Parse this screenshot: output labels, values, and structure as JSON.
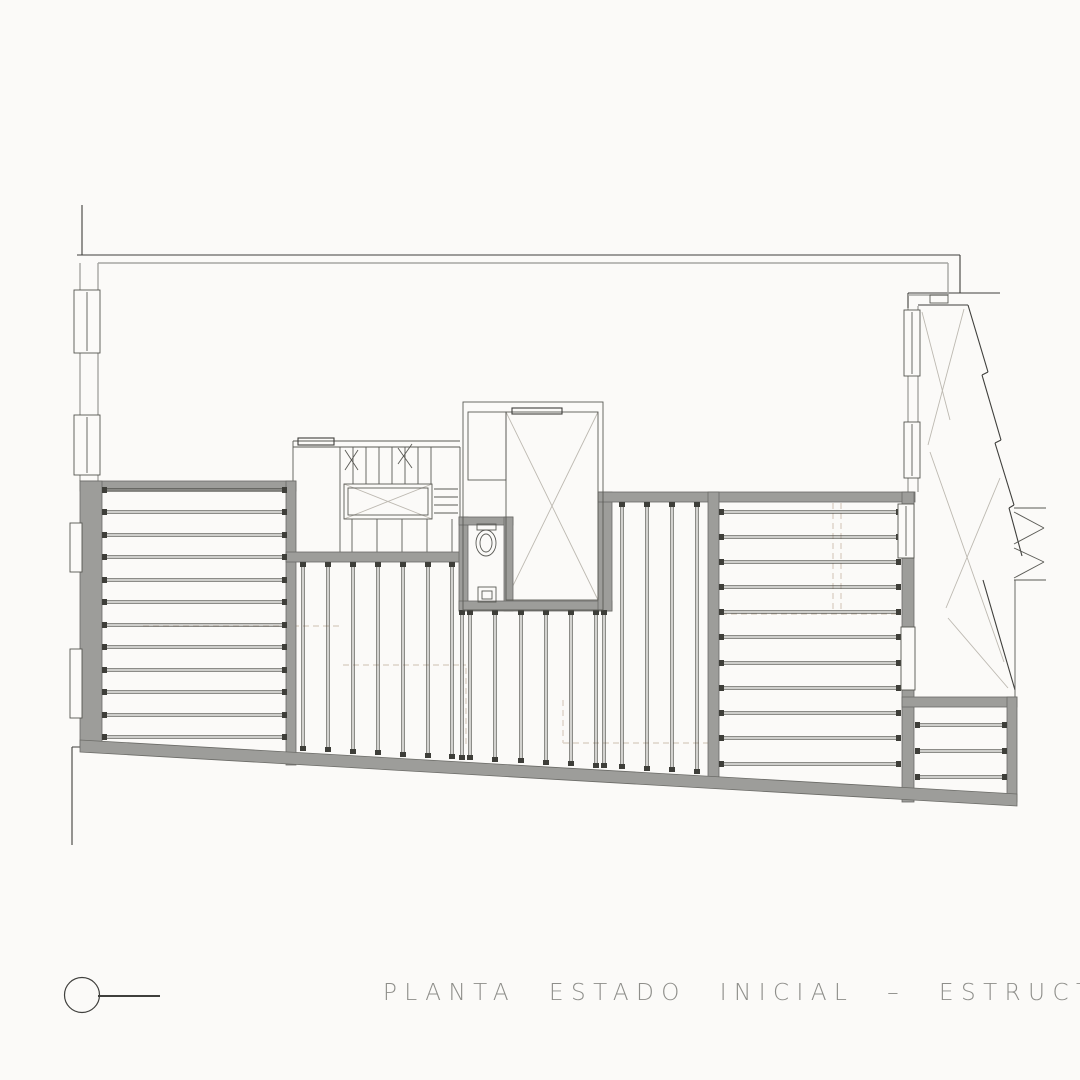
{
  "title": {
    "text": "PLANTA ESTADO INICIAL – ESTRUCTURA",
    "color": "#8e8e8a"
  },
  "marker": {
    "icon": "circle-dash-orientation-icon"
  },
  "colors": {
    "background": "#fbfaf8",
    "wall_fill": "#9d9d9a",
    "wall_edge": "#6b6b67",
    "dark_line": "#3f3f3c",
    "medium_line": "#a6a6a2",
    "thin_line": "#5a5a55",
    "light_diagonal": "#bdb9b1",
    "dashed_hidden": "#ddd3c8",
    "joist": "#4a4a44",
    "title_text": "#8e8e8a"
  },
  "plan": {
    "viewbox": "0 0 1080 1080",
    "base_lines": [
      [
        82,
        205,
        82,
        255,
        "ld"
      ],
      [
        77,
        255,
        960,
        255,
        "ld"
      ],
      [
        960,
        255,
        960,
        293,
        "ld"
      ],
      [
        908,
        293,
        1000,
        293,
        "ld"
      ],
      [
        908,
        293,
        908,
        308,
        "ld"
      ],
      [
        72,
        747,
        92,
        747,
        "ld"
      ],
      [
        72,
        747,
        72,
        845,
        "ld"
      ],
      [
        98,
        263,
        948,
        263,
        "lm"
      ],
      [
        948,
        263,
        948,
        295,
        "lm"
      ],
      [
        908,
        295,
        948,
        295,
        "lm"
      ],
      [
        80,
        263,
        80,
        481,
        "lm"
      ],
      [
        98,
        263,
        98,
        481,
        "lm"
      ],
      [
        908,
        308,
        908,
        492,
        "lm"
      ],
      [
        918,
        306,
        918,
        492,
        "lm"
      ],
      [
        293,
        441,
        460,
        441,
        "lt"
      ],
      [
        293,
        447,
        460,
        447,
        "lt"
      ],
      [
        293,
        441,
        293,
        483,
        "lt"
      ],
      [
        340,
        447,
        340,
        552,
        "lt"
      ],
      [
        460,
        447,
        460,
        552,
        "lt"
      ],
      [
        353,
        447,
        353,
        484,
        "lt"
      ],
      [
        366,
        447,
        366,
        484,
        "lt"
      ],
      [
        379,
        447,
        379,
        484,
        "lt"
      ],
      [
        392,
        447,
        392,
        484,
        "lt"
      ],
      [
        405,
        447,
        405,
        484,
        "lt"
      ],
      [
        418,
        447,
        418,
        484,
        "lt"
      ],
      [
        431,
        447,
        431,
        484,
        "lt"
      ],
      [
        434,
        489,
        458,
        489,
        "lt"
      ],
      [
        434,
        497,
        458,
        497,
        "lt"
      ],
      [
        434,
        505,
        458,
        505,
        "lt"
      ],
      [
        434,
        513,
        458,
        513,
        "lt"
      ],
      [
        352,
        519,
        352,
        552,
        "lt"
      ],
      [
        377,
        519,
        377,
        552,
        "lt"
      ],
      [
        402,
        519,
        402,
        552,
        "lt"
      ],
      [
        427,
        519,
        427,
        552,
        "lt"
      ],
      [
        452,
        519,
        452,
        552,
        "lt"
      ],
      [
        345,
        450,
        358,
        470,
        "lt"
      ],
      [
        358,
        450,
        345,
        470,
        "lt"
      ],
      [
        398,
        448,
        412,
        468,
        "lt"
      ],
      [
        412,
        444,
        398,
        464,
        "lt"
      ],
      [
        344,
        484,
        432,
        519,
        "ll"
      ],
      [
        432,
        484,
        344,
        519,
        "ll"
      ],
      [
        506,
        412,
        598,
        600,
        "ll"
      ],
      [
        598,
        412,
        506,
        600,
        "ll"
      ],
      [
        918,
        305,
        968,
        305,
        "ld"
      ],
      [
        968,
        305,
        988,
        372,
        "ld"
      ],
      [
        988,
        372,
        982,
        375,
        "ld"
      ],
      [
        982,
        375,
        1001,
        440,
        "ld"
      ],
      [
        1001,
        440,
        995,
        443,
        "ld"
      ],
      [
        995,
        443,
        1014,
        505,
        "ld"
      ],
      [
        1014,
        505,
        1009,
        508,
        "ld"
      ],
      [
        1009,
        508,
        1022,
        556,
        "ld"
      ],
      [
        983,
        580,
        1015,
        690,
        "ld"
      ],
      [
        1015,
        580,
        1015,
        697,
        "lt"
      ],
      [
        1014,
        508,
        1046,
        508,
        "lt"
      ],
      [
        1014,
        580,
        1046,
        580,
        "lt"
      ],
      [
        1014,
        512,
        1044,
        528,
        "lt"
      ],
      [
        1044,
        528,
        1014,
        544,
        "lt"
      ],
      [
        1014,
        548,
        1044,
        562,
        "lt"
      ],
      [
        1044,
        562,
        1014,
        578,
        "lt"
      ],
      [
        922,
        312,
        950,
        420,
        "ll"
      ],
      [
        964,
        309,
        928,
        445,
        "ll"
      ],
      [
        930,
        452,
        1004,
        662,
        "ll"
      ],
      [
        1000,
        478,
        946,
        608,
        "ll"
      ],
      [
        948,
        618,
        1008,
        688,
        "ll"
      ],
      [
        143,
        626,
        340,
        626,
        "dsh"
      ],
      [
        343,
        665,
        466,
        665,
        "dsh"
      ],
      [
        466,
        668,
        466,
        745,
        "dsh"
      ],
      [
        563,
        700,
        563,
        743,
        "dsh"
      ],
      [
        563,
        743,
        712,
        743,
        "dsh"
      ],
      [
        721,
        614,
        900,
        614,
        "dsh"
      ],
      [
        833,
        503,
        833,
        611,
        "dsh"
      ],
      [
        841,
        503,
        841,
        611,
        "dsh"
      ]
    ],
    "walls": [
      [
        80,
        481,
        216,
        10
      ],
      [
        80,
        481,
        22,
        267
      ],
      [
        286,
        481,
        10,
        284
      ],
      [
        286,
        552,
        180,
        10
      ],
      [
        459,
        517,
        9,
        94
      ],
      [
        459,
        517,
        54,
        8
      ],
      [
        504,
        517,
        9,
        94
      ],
      [
        459,
        601,
        153,
        10
      ],
      [
        598,
        492,
        14,
        119
      ],
      [
        598,
        492,
        317,
        10
      ],
      [
        708,
        492,
        11,
        292
      ],
      [
        902,
        492,
        12,
        310
      ],
      [
        902,
        697,
        115,
        10
      ],
      [
        1007,
        697,
        10,
        105
      ]
    ],
    "polygons": [
      {
        "points": "80,740 1017,794 1017,806 80,752",
        "cls": "wall",
        "name": "bottom-slanted-wall"
      }
    ],
    "joists": [
      {
        "dir": "h",
        "x1": 104,
        "x2": 285,
        "ys": [
          490,
          512,
          535,
          557,
          580,
          602,
          625,
          647,
          670,
          692,
          715,
          737
        ],
        "name": "room-left-joists"
      },
      {
        "dir": "v",
        "y1": 564,
        "xs": [
          303,
          328,
          353,
          378,
          403,
          428,
          452
        ],
        "y2": [
          749,
          750,
          752,
          753,
          755,
          756,
          757
        ],
        "name": "room-mid-left-joists"
      },
      {
        "dir": "v",
        "y1": 612,
        "xs": [
          462
        ],
        "y2": [
          758
        ],
        "name": "joist-under-wc"
      },
      {
        "dir": "v",
        "y1": 612,
        "xs": [
          470,
          495,
          521,
          546,
          571,
          596,
          604
        ],
        "y2": [
          758,
          760,
          761,
          763,
          764,
          766,
          766
        ],
        "name": "room-under-patio-joists"
      },
      {
        "dir": "v",
        "y1": 504,
        "xs": [
          622,
          647,
          672,
          697
        ],
        "y2": [
          767,
          769,
          770,
          772
        ],
        "name": "room-mid-right-joists"
      },
      {
        "dir": "h",
        "x1": 721,
        "x2": 899,
        "ys": [
          512,
          537,
          562,
          587,
          612,
          637,
          663,
          688,
          713,
          738,
          764
        ],
        "name": "room-right-joists"
      },
      {
        "dir": "h",
        "x1": 917,
        "x2": 1005,
        "ys": [
          725,
          751,
          777
        ],
        "name": "room-small-se-joists"
      }
    ],
    "overlay_rects": [
      [
        74,
        290,
        26,
        63,
        "win"
      ],
      [
        74,
        415,
        26,
        60,
        "win"
      ],
      [
        70,
        523,
        12,
        49,
        "win"
      ],
      [
        70,
        649,
        12,
        69,
        "win"
      ],
      [
        904,
        310,
        16,
        66,
        "win"
      ],
      [
        904,
        422,
        16,
        56,
        "win"
      ],
      [
        898,
        504,
        16,
        54,
        "win"
      ],
      [
        901,
        627,
        14,
        63,
        "win"
      ],
      [
        930,
        295,
        18,
        8,
        "rt"
      ],
      [
        344,
        484,
        88,
        35,
        "rt"
      ],
      [
        348,
        488,
        80,
        27,
        "rt"
      ],
      [
        463,
        402,
        140,
        208,
        "rt"
      ],
      [
        468,
        412,
        38,
        68,
        "rt"
      ],
      [
        506,
        412,
        92,
        188,
        "rt"
      ],
      [
        512,
        408,
        50,
        6,
        "rd"
      ],
      [
        298,
        438,
        36,
        7,
        "rd"
      ],
      [
        478,
        587,
        18,
        15,
        "rt"
      ],
      [
        482,
        591,
        10,
        8,
        "rt"
      ],
      [
        477,
        524,
        19,
        6,
        "rt"
      ]
    ],
    "overlay_lines": [
      [
        87,
        292,
        87,
        351,
        "lt"
      ],
      [
        87,
        417,
        87,
        473,
        "lt"
      ],
      [
        912,
        312,
        912,
        374,
        "lt"
      ],
      [
        912,
        424,
        912,
        476,
        "lt"
      ],
      [
        906,
        506,
        906,
        556,
        "lt"
      ]
    ],
    "ellipses": [
      [
        486,
        543,
        10,
        13,
        "rt"
      ],
      [
        486,
        543,
        6,
        9,
        "rt"
      ]
    ]
  }
}
